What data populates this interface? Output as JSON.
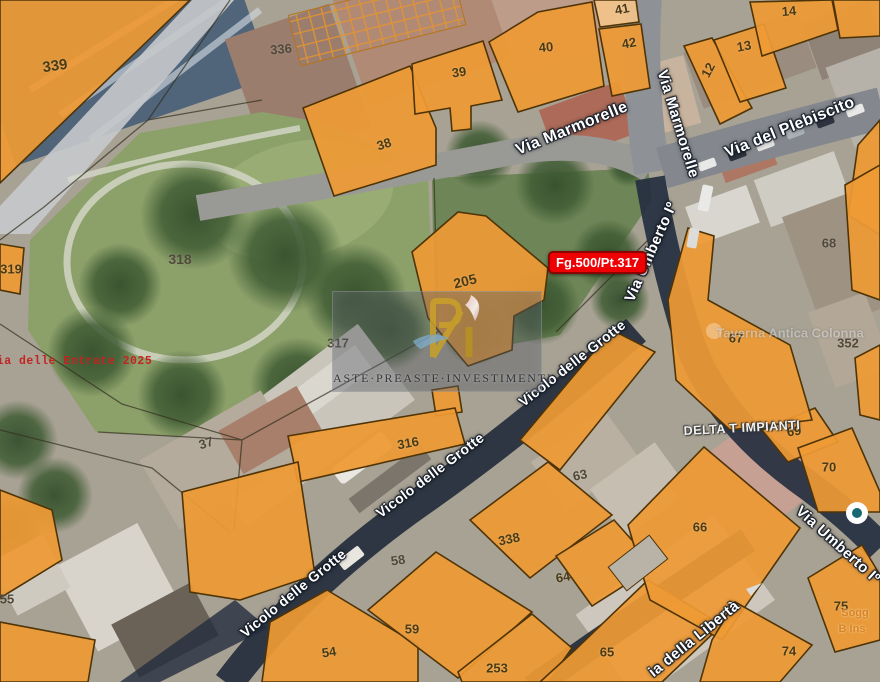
{
  "annotations": {
    "cadastral_badge": "Fg.500/Pt.317",
    "source_note": "nzia delle Entrate 2025"
  },
  "watermark": {
    "brand": "ASTE·PREASTE·INVESTIMENTI"
  },
  "parcels": [
    {
      "id": "339"
    },
    {
      "id": "336"
    },
    {
      "id": "38"
    },
    {
      "id": "39"
    },
    {
      "id": "40"
    },
    {
      "id": "41"
    },
    {
      "id": "42"
    },
    {
      "id": "12"
    },
    {
      "id": "13"
    },
    {
      "id": "14"
    },
    {
      "id": "318"
    },
    {
      "id": "319"
    },
    {
      "id": "205"
    },
    {
      "id": "317"
    },
    {
      "id": "37"
    },
    {
      "id": "316"
    },
    {
      "id": "55"
    },
    {
      "id": "58"
    },
    {
      "id": "338"
    },
    {
      "id": "63"
    },
    {
      "id": "64"
    },
    {
      "id": "59"
    },
    {
      "id": "54"
    },
    {
      "id": "253"
    },
    {
      "id": "65"
    },
    {
      "id": "66"
    },
    {
      "id": "67"
    },
    {
      "id": "68"
    },
    {
      "id": "352"
    },
    {
      "id": "69"
    },
    {
      "id": "70"
    },
    {
      "id": "75"
    },
    {
      "id": "74"
    }
  ],
  "streets": [
    {
      "name": "Via Marmorelle"
    },
    {
      "name": "Via Marmorelle"
    },
    {
      "name": "Via del Plebiscito"
    },
    {
      "name": "Via Umberto Iº"
    },
    {
      "name": "Via Umberto Iº"
    },
    {
      "name": "Vicolo delle Grotte"
    },
    {
      "name": "Vicolo delle Grotte"
    },
    {
      "name": "Vicolo delle Grotte"
    },
    {
      "name": "ia della Libertà"
    }
  ],
  "pois": [
    {
      "name": "Taverna Antica Colonna"
    },
    {
      "name": "DELTA T IMPIANTI"
    },
    {
      "name": "Sogg"
    },
    {
      "name": "B Ins"
    }
  ],
  "colors": {
    "parcel_fill": "#EE9A35",
    "parcel_outline": "#4F3407",
    "badge_bg": "#EF0003",
    "road_dark": "#232C3B"
  }
}
